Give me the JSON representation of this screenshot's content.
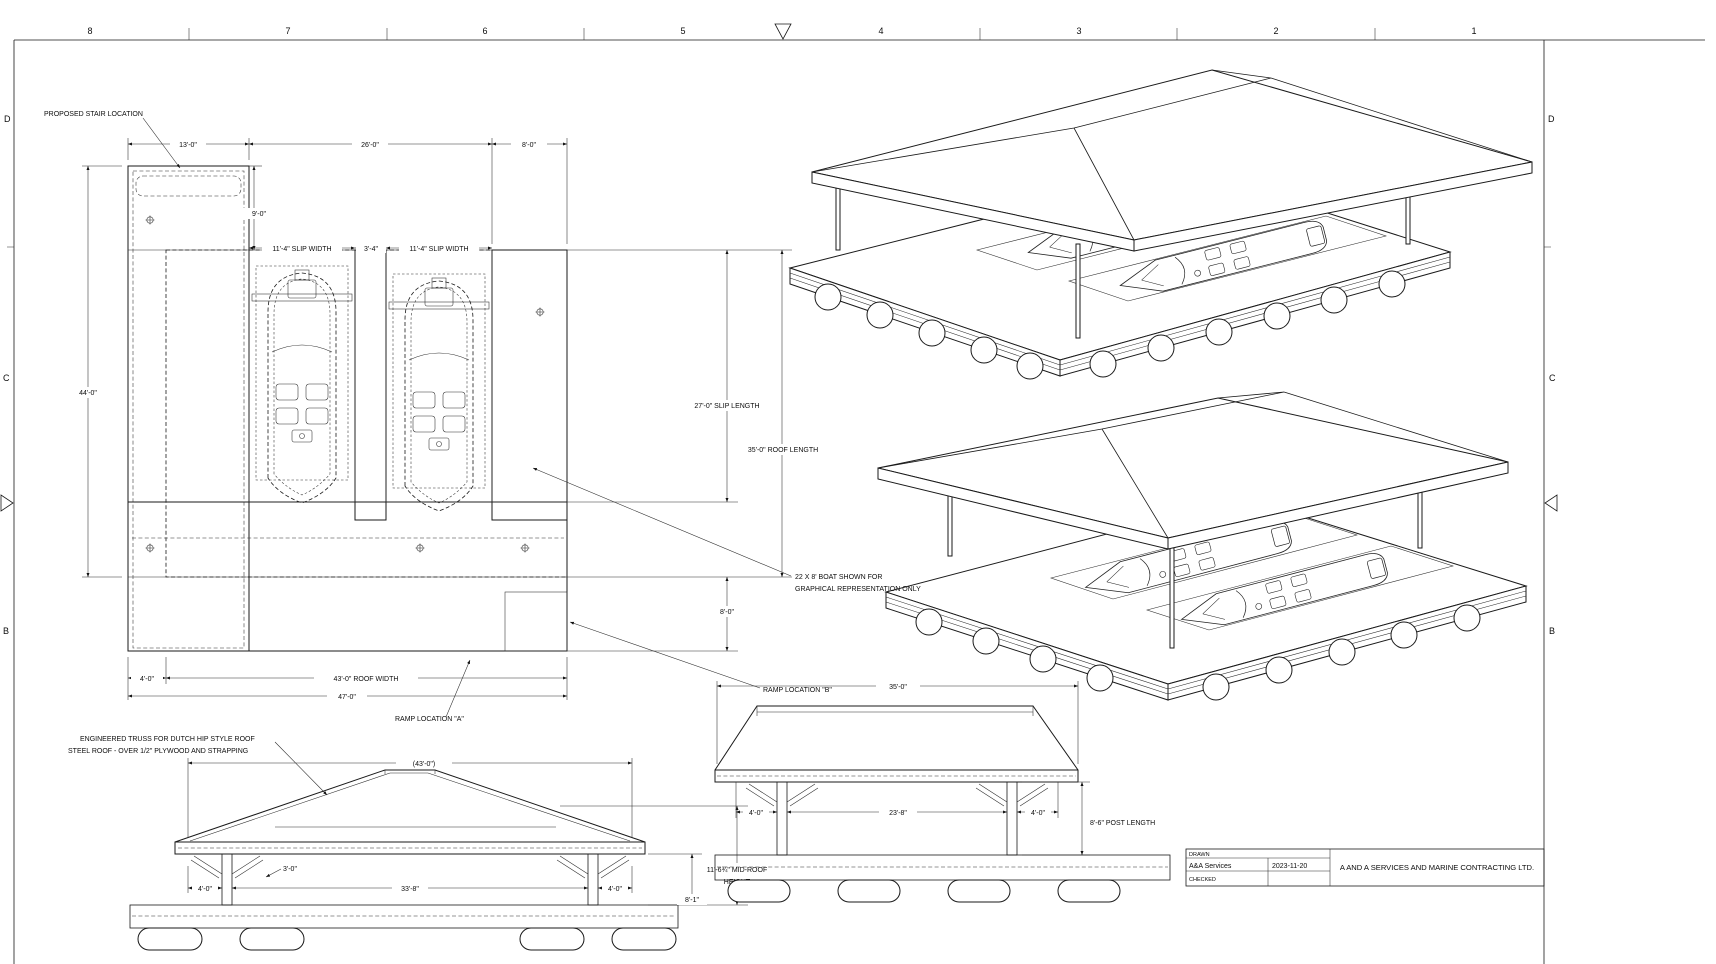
{
  "sheet": {
    "columns": [
      "8",
      "7",
      "6",
      "5",
      "4",
      "3",
      "2",
      "1"
    ],
    "rows": [
      "D",
      "C",
      "B"
    ],
    "title_block": {
      "drawn_label": "DRAWN",
      "drawn_by": "A&A Services",
      "date": "2023-11-20",
      "checked_label": "CHECKED",
      "company": "A AND A SERVICES AND MARINE CONTRACTING LTD."
    }
  },
  "plan": {
    "stair_callout": "PROPOSED STAIR LOCATION",
    "dim_stair_width": "13'-0\"",
    "dim_opening": "26'-0\"",
    "dim_walkway": "8'-0\"",
    "dim_stair_depth": "9'-0\"",
    "dim_slip_width_1": "11'-4\" SLIP WIDTH",
    "dim_finger": "3'-4\"",
    "dim_slip_width_2": "11'-4\" SLIP WIDTH",
    "dim_dock_length": "44'-0\"",
    "dim_slip_length": "27'-0\" SLIP LENGTH",
    "dim_roof_length": "35'-0\" ROOF LENGTH",
    "boat_note_line1": "22 X 8' BOAT SHOWN FOR",
    "boat_note_line2": "GRAPHICAL REPRESENTATION ONLY",
    "dim_lower_walkway": "8'-0\"",
    "dim_left_offset": "4'-0\"",
    "dim_roof_width": "43'-0\" ROOF WIDTH",
    "dim_total_width": "47'-0\"",
    "ramp_a": "RAMP LOCATION \"A\"",
    "ramp_b": "RAMP LOCATION \"B\""
  },
  "front_elevation": {
    "truss_note_line1": "ENGINEERED TRUSS FOR DUTCH HIP STYLE ROOF",
    "truss_note_line2": "STEEL ROOF - OVER 1/2\" PLYWOOD AND STRAPPING",
    "dim_roof_width": "(43'-0\")",
    "dim_brace": "3'-0\"",
    "dim_overhang_left": "4'-0\"",
    "dim_span": "33'-8\"",
    "dim_overhang_right": "4'-0\"",
    "dim_deck_height": "8'-1\"",
    "dim_mid_roof_line1": "11'-6¾\" MID-ROOF",
    "dim_mid_roof_line2": "HEIGHT"
  },
  "side_elevation": {
    "dim_roof_length": "35'-0\"",
    "dim_overhang_left": "4'-0\"",
    "dim_span": "23'-8\"",
    "dim_overhang_right": "4'-0\"",
    "dim_post_length": "8'-6\" POST LENGTH"
  }
}
